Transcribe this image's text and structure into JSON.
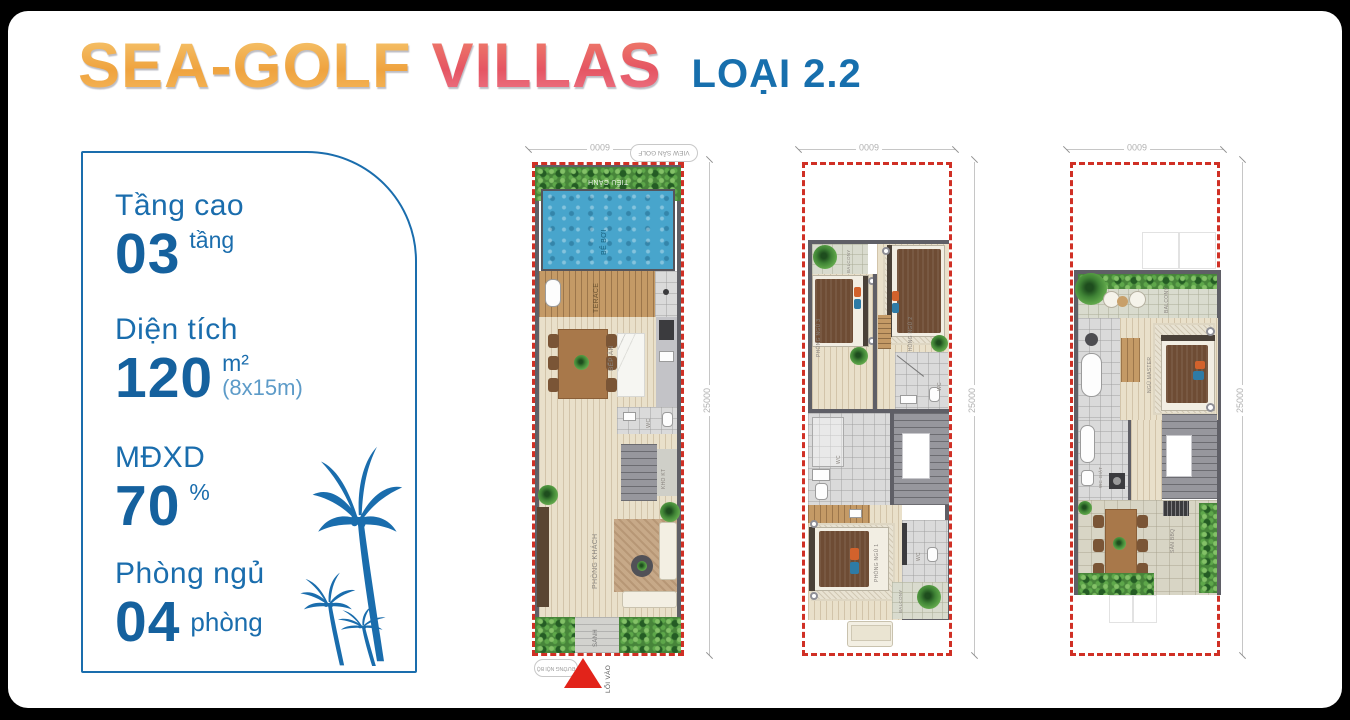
{
  "header": {
    "brand_first": "SEA-GOLF",
    "brand_second": "VILLAS",
    "variant": "LOẠI 2.2"
  },
  "specs": [
    {
      "label": "Tầng cao",
      "value": "03",
      "unit": "tầng",
      "note": ""
    },
    {
      "label": "Diện tích",
      "value": "120",
      "unit": "m²",
      "note": "(8x15m)"
    },
    {
      "label": "MĐXD",
      "value": "70",
      "unit": "%",
      "note": ""
    },
    {
      "label": "Phòng ngủ",
      "value": "04",
      "unit": "phòng",
      "note": ""
    }
  ],
  "dimensions": {
    "width": "6000",
    "depth": "25000"
  },
  "floor1": {
    "view_badge": "VIEW SÂN GOLF",
    "garden": "TIỂU CẢNH",
    "pool": "BỂ BƠI",
    "terrace": "TERACE",
    "wc": "WC",
    "dining": "BẾP ĂN",
    "storage": "KHO KT",
    "living": "PHÒNG KHÁCH",
    "lobby": "SẢNH",
    "entry": "LỐI VÀO",
    "road": "ĐƯỜNG NỘI BỘ"
  },
  "floor2": {
    "balcony_top": "BALCONY",
    "bedroom3": "PHÒNG NGỦ 3",
    "bedroom2": "PHÒNG NGỦ 2",
    "wc_right": "WC",
    "wc_left": "WC",
    "bedroom1": "PHÒNG NGỦ 1",
    "wc_bottom": "WC",
    "balcony_bottom": "BALCONY"
  },
  "floor3": {
    "balcony": "BALCONY",
    "master": "NGỦ MASTER",
    "laundry": "WC GIẶT",
    "bbq": "SÂN BBQ"
  },
  "colors": {
    "accent_blue": "#1a6dad",
    "brand_orange": "#efa33f",
    "brand_pink": "#e55563",
    "dashed_red": "#d03025"
  }
}
